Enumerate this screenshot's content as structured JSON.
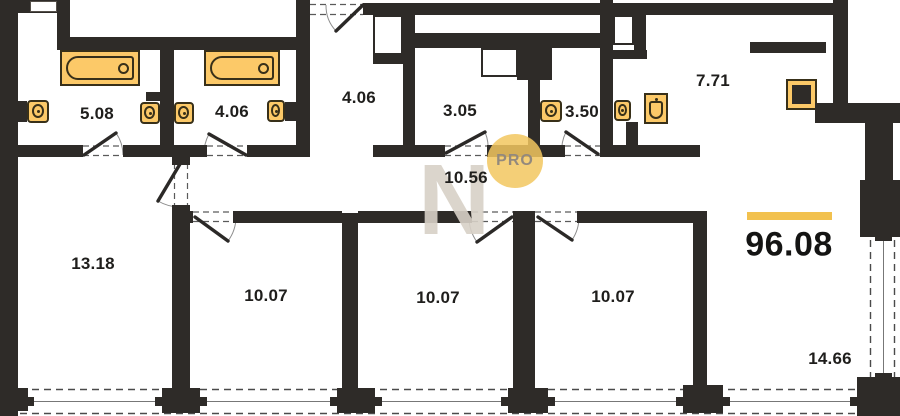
{
  "plan": {
    "title": "apartment-floor-plan",
    "total_area": "96.08",
    "total_underline_color": "#f2c14e",
    "watermark": {
      "letter": "N",
      "badge": "PRO"
    },
    "rooms": [
      {
        "name": "bathroom-1",
        "area": "5.08"
      },
      {
        "name": "bathroom-2",
        "area": "4.06"
      },
      {
        "name": "entry-hall",
        "area": "4.06"
      },
      {
        "name": "wc-1",
        "area": "3.05"
      },
      {
        "name": "wc-2",
        "area": "3.50"
      },
      {
        "name": "kitchen",
        "area": "7.71"
      },
      {
        "name": "corridor",
        "area": "10.56"
      },
      {
        "name": "bedroom-1",
        "area": "13.18"
      },
      {
        "name": "bedroom-2",
        "area": "10.07"
      },
      {
        "name": "bedroom-3",
        "area": "10.07"
      },
      {
        "name": "bedroom-4",
        "area": "10.07"
      },
      {
        "name": "living-room",
        "area": "14.66"
      }
    ],
    "colors": {
      "wall": "#2e2b28",
      "fixture_fill": "#fcc968",
      "fixture_border": "#383019",
      "accent_yellow": "#f2c14e",
      "watermark_gray": "#d8d1c7",
      "label_text": "#1f1e1c"
    }
  }
}
